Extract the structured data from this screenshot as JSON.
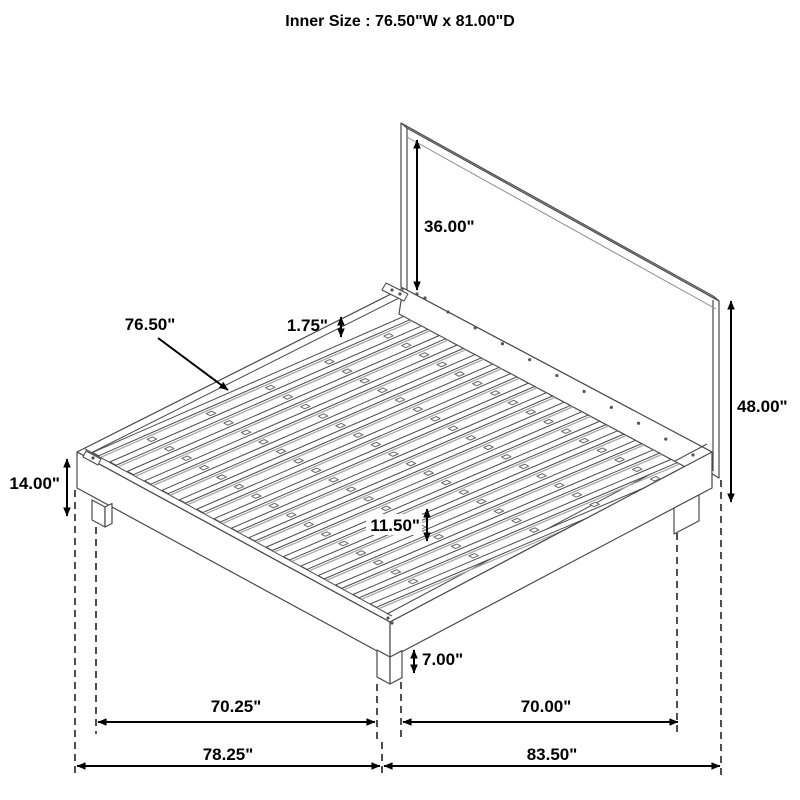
{
  "title": "Inner Size : 76.50\"W x 81.00\"D",
  "inner_size": {
    "width_label": "76.50\"W",
    "depth_label": "81.00\"D",
    "width_in": 76.5,
    "depth_in": 81.0
  },
  "labels": {
    "headboard_above_deck": "36.00\"",
    "slat_span": "76.50\"",
    "slat_thickness": "1.75\"",
    "overall_height": "48.00\"",
    "platform_height": "14.00\"",
    "center_support_gap": "11.50\"",
    "leg_height": "7.00\"",
    "leg_span_left": "70.25\"",
    "leg_span_right": "70.00\"",
    "overall_width": "78.25\"",
    "overall_depth": "83.50\""
  },
  "dimensions_in": {
    "headboard_above_deck": 36.0,
    "slat_span": 76.5,
    "slat_thickness": 1.75,
    "overall_height": 48.0,
    "platform_height": 14.0,
    "center_support_gap": 11.5,
    "leg_height": 7.0,
    "leg_span_left": 70.25,
    "leg_span_right": 70.0,
    "overall_width": 78.25,
    "overall_depth": 83.5
  },
  "render": {
    "slat_count": 17,
    "block_rows": [
      0.14,
      0.33,
      0.52,
      0.71,
      0.9
    ],
    "back_rail_dots": 10,
    "line_color": "#4a4a4a",
    "slat_shade_color": "#a8a8a8",
    "dim_color": "#000000",
    "bg_color": "#ffffff"
  }
}
